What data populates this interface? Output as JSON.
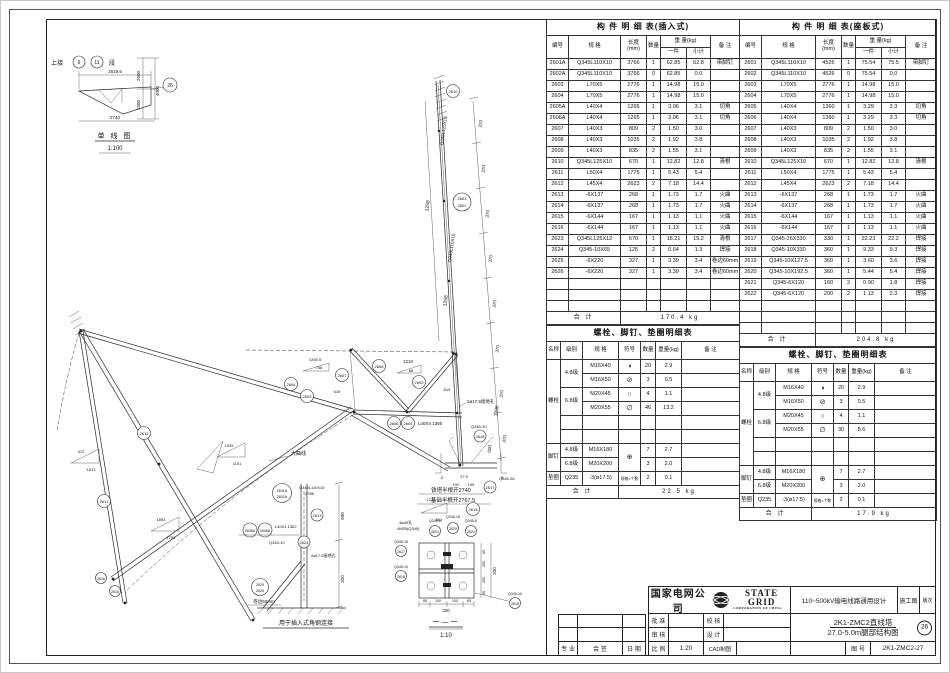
{
  "drawing": {
    "labels": {
      "shangjie": "上接",
      "c6": "6",
      "c11": "11",
      "duan": "段",
      "d2619": "2619.5",
      "d2500": "2500",
      "d4000": "4000",
      "d1500": "1500",
      "c26": "26",
      "d2740": "2740",
      "sl_title": "单 线 图",
      "sl_scale": "1:100",
      "p2610": "2610",
      "p2601": "2601",
      "p2602": "2602",
      "spec125": "Q345L125X10",
      "spec110": "Q345L110X10",
      "d1258": "1258",
      "d370": "370",
      "d1296": "1296",
      "d600": "600",
      "d320": "320",
      "p2603": "2603",
      "p2604": "2604",
      "p2611": "2611",
      "p2612": "2612",
      "p2607": "2607",
      "p2608": "2608",
      "p2609": "2609",
      "p2605": "2605",
      "p2606": "2606",
      "h2605": "L40X4 1360",
      "p2613": "2613",
      "p2614": "2614",
      "p2615": "2615",
      "p2616": "2616",
      "p2624": "2624",
      "q34510": "Q345-10",
      "p2625": "2625",
      "p2626": "2626",
      "juanbian": "卷边60mm",
      "p2601A": "2601A",
      "p2602A": "2602A",
      "len2766": "2766",
      "p2605A": "2605A",
      "p2606A": "2606A",
      "h2605A": "L40X4 1362",
      "jiedikong": "2ø17.5接地孔",
      "tower_half": "铁塔半根开2740",
      "found_half": "基础半根开2767.5",
      "p2617": "2617",
      "p2618": "2618",
      "p2619": "2619",
      "p2620": "2620",
      "p2621": "2621",
      "p2622": "2622",
      "q34526": "Q345-26",
      "q3456": "Q345-6",
      "q34516": "Q345-16",
      "holes": "4ø40孔",
      "boltsM": "4M30(Q345)",
      "sec_label": "一—一",
      "sec_scale": "1:10",
      "insert_note": "用于插入式角钢连接",
      "daquxian": "大曲线",
      "d372": "372",
      "d1813": "1813",
      "d1945": "1945",
      "d1151": "1151",
      "d1269": "1269.5",
      "d748": "748",
      "d1210": "1210",
      "d68": "68",
      "d615": "615",
      "d561": "561",
      "d1853": "1853",
      "d1751": "1751",
      "d330": "330",
      "d65": "65",
      "d100": "100",
      "d105": "105",
      "d27_5": "27.5",
      "sec_mark": "1"
    }
  },
  "tables": {
    "col": {
      "no": "编号",
      "spec": "规 格",
      "len": "长度 (mm)",
      "qty": "数量",
      "wt": "重 量(kg)",
      "one": "一件",
      "sub": "小计",
      "note": "备 注",
      "total_label": "合  计"
    },
    "insert": {
      "title": "构 件 明 细 表(插入式)",
      "rows": [
        [
          "2601A",
          "Q345L110X10",
          "3766",
          "1",
          "62.85",
          "62.8",
          "带脚钉"
        ],
        [
          "2602A",
          "Q345L110X10",
          "3766",
          "0",
          "62.85",
          "0.0",
          ""
        ],
        [
          "2603",
          "L70X5",
          "2776",
          "1",
          "14.98",
          "15.0",
          ""
        ],
        [
          "2604",
          "L70X5",
          "2776",
          "1",
          "14.98",
          "15.0",
          ""
        ],
        [
          "2605A",
          "L40X4",
          "1265",
          "1",
          "3.06",
          "3.1",
          "切角"
        ],
        [
          "2606A",
          "L40X4",
          "1265",
          "1",
          "3.06",
          "3.1",
          "切角"
        ],
        [
          "2607",
          "L40X3",
          "809",
          "2",
          "1.50",
          "3.0",
          ""
        ],
        [
          "2608",
          "L40X3",
          "1035",
          "2",
          "1.92",
          "3.8",
          ""
        ],
        [
          "2609",
          "L40X3",
          "835",
          "2",
          "1.55",
          "3.1",
          ""
        ],
        [
          "2610",
          "Q345L125X10",
          "670",
          "1",
          "12.82",
          "12.8",
          "清根"
        ],
        [
          "2611",
          "L50X4",
          "1775",
          "1",
          "5.43",
          "5.4",
          ""
        ],
        [
          "2612",
          "L45X4",
          "2623",
          "2",
          "7.18",
          "14.4",
          ""
        ],
        [
          "2613",
          "-6X137",
          "268",
          "1",
          "1.73",
          "1.7",
          "火曲"
        ],
        [
          "2614",
          "-6X137",
          "268",
          "1",
          "1.73",
          "1.7",
          "火曲"
        ],
        [
          "2615",
          "-6X144",
          "167",
          "1",
          "1.13",
          "1.1",
          "火曲"
        ],
        [
          "2616",
          "-6X144",
          "167",
          "1",
          "1.13",
          "1.1",
          "火曲"
        ],
        [
          "2623",
          "Q345L125X12",
          "670",
          "1",
          "15.21",
          "15.2",
          "清根"
        ],
        [
          "2624",
          "Q345-10X65",
          "125",
          "2",
          "0.64",
          "1.3",
          "焊接"
        ],
        [
          "2625",
          "-6X220",
          "327",
          "1",
          "3.39",
          "3.4",
          "卷边60mm"
        ],
        [
          "2626",
          "-6X220",
          "327",
          "1",
          "3.39",
          "3.4",
          "卷边60mm"
        ],
        [
          "",
          "",
          "",
          "",
          "",
          "",
          ""
        ],
        [
          "",
          "",
          "",
          "",
          "",
          "",
          ""
        ],
        [
          "",
          "",
          "",
          "",
          "",
          "",
          ""
        ]
      ],
      "total": "170.4 kg"
    },
    "seat": {
      "title": "构 件 明 细 表(座板式)",
      "rows": [
        [
          "2601",
          "Q345L110X10",
          "4526",
          "1",
          "75.54",
          "75.5",
          "带脚钉"
        ],
        [
          "2602",
          "Q345L110X10",
          "4526",
          "0",
          "75.54",
          "0.0",
          ""
        ],
        [
          "2603",
          "L70X5",
          "2776",
          "1",
          "14.98",
          "15.0",
          ""
        ],
        [
          "2604",
          "L70X5",
          "2776",
          "1",
          "14.98",
          "15.0",
          ""
        ],
        [
          "2605",
          "L40X4",
          "1360",
          "1",
          "3.29",
          "3.3",
          "切角"
        ],
        [
          "2606",
          "L40X4",
          "1360",
          "1",
          "3.29",
          "3.3",
          "切角"
        ],
        [
          "2607",
          "L40X3",
          "809",
          "2",
          "1.50",
          "3.0",
          ""
        ],
        [
          "2608",
          "L40X3",
          "1035",
          "2",
          "1.92",
          "3.8",
          ""
        ],
        [
          "2609",
          "L40X3",
          "835",
          "2",
          "1.55",
          "3.1",
          ""
        ],
        [
          "2610",
          "Q345L125X10",
          "670",
          "1",
          "12.82",
          "12.8",
          "清根"
        ],
        [
          "2611",
          "L50X4",
          "1775",
          "1",
          "5.43",
          "5.4",
          ""
        ],
        [
          "2612",
          "L45X4",
          "2623",
          "2",
          "7.18",
          "14.4",
          ""
        ],
        [
          "2613",
          "-6X137",
          "268",
          "1",
          "1.73",
          "1.7",
          "火曲"
        ],
        [
          "2614",
          "-6X137",
          "268",
          "1",
          "1.73",
          "1.7",
          "火曲"
        ],
        [
          "2615",
          "-6X144",
          "167",
          "1",
          "1.13",
          "1.1",
          "火曲"
        ],
        [
          "2616",
          "-6X144",
          "167",
          "1",
          "1.13",
          "1.1",
          "火曲"
        ],
        [
          "2617",
          "Q345-26X330",
          "330",
          "1",
          "22.23",
          "22.2",
          "焊接"
        ],
        [
          "2618",
          "Q345-10X330",
          "360",
          "1",
          "9.33",
          "9.3",
          "焊接"
        ],
        [
          "2619",
          "Q345-10X127.5",
          "360",
          "1",
          "3.60",
          "3.6",
          "焊接"
        ],
        [
          "2620",
          "Q345-10X192.5",
          "360",
          "1",
          "5.44",
          "5.4",
          "焊接"
        ],
        [
          "2621",
          "Q345-6X120",
          "160",
          "2",
          "0.90",
          "1.8",
          "焊接"
        ],
        [
          "2622",
          "Q345-6X120",
          "200",
          "2",
          "1.13",
          "2.3",
          "焊接"
        ],
        [
          "",
          "",
          "",
          "",
          "",
          "",
          ""
        ],
        [
          "",
          "",
          "",
          "",
          "",
          "",
          ""
        ],
        [
          "",
          "",
          "",
          "",
          "",
          "",
          ""
        ]
      ],
      "total": "204.8 kg"
    },
    "boltcol": {
      "name": "名称",
      "grade": "级别",
      "spec": "规 格",
      "sym": "符号",
      "qty": "数量",
      "wt": "重量(kg)",
      "note": "备 注",
      "total_label": "合  计"
    },
    "bolt_left": {
      "title": "螺栓、脚钉、垫圈明细表",
      "bolt": "螺栓",
      "foot": "脚钉",
      "washer": "垫圈",
      "rows": [
        {
          "grade": "4.8级",
          "spec": "M16X40",
          "sym": "◑",
          "qty": "20",
          "wt": "2.9"
        },
        {
          "spec": "M16X50",
          "sym": "⊘",
          "qty": "3",
          "wt": "0.5"
        },
        {
          "grade": "6.8级",
          "spec": "M20X45",
          "sym": "○",
          "qty": "4",
          "wt": "1.1"
        },
        {
          "spec": "M20X55",
          "sym": "∅",
          "qty": "46",
          "wt": "13.2"
        }
      ],
      "foot_rows": [
        {
          "grade": "4.8级",
          "spec": "M16X180",
          "qty": "7",
          "wt": "2.7"
        },
        {
          "grade": "6.8级",
          "spec": "M20X200",
          "qty": "3",
          "wt": "2.0"
        }
      ],
      "foot_sym": "⊕",
      "washer_row": {
        "grade": "Q235",
        "spec": "-3(ø17.5)",
        "sym": "规格×个数",
        "qty": "2",
        "wt": "0.1"
      },
      "total": "22.5 kg"
    },
    "bolt_right": {
      "title": "螺栓、脚钉、垫圈明细表",
      "bolt": "螺栓",
      "foot": "脚钉",
      "washer": "垫圈",
      "rows": [
        {
          "grade": "4.8级",
          "spec": "M16X40",
          "sym": "◑",
          "qty": "20",
          "wt": "2.9"
        },
        {
          "spec": "M16X50",
          "sym": "⊘",
          "qty": "3",
          "wt": "0.5"
        },
        {
          "grade": "6.8级",
          "spec": "M20X45",
          "sym": "○",
          "qty": "4",
          "wt": "1.1"
        },
        {
          "spec": "M20X55",
          "sym": "∅",
          "qty": "30",
          "wt": "8.6"
        }
      ],
      "foot_rows": [
        {
          "grade": "4.8级",
          "spec": "M16X180",
          "qty": "7",
          "wt": "2.7"
        },
        {
          "grade": "6.8级",
          "spec": "M20X200",
          "qty": "3",
          "wt": "2.0"
        }
      ],
      "foot_sym": "⊕",
      "washer_row": {
        "grade": "Q235",
        "spec": "-3(ø17.5)",
        "sym": "规格×个数",
        "qty": "2",
        "wt": "0.1"
      },
      "total": "17.9 kg"
    }
  },
  "titleblock": {
    "company": "国家电网公司",
    "brand": "STATE GRID",
    "brand_sub": "CORPORATION OF CHINA",
    "project": "110~500kV输电线路通用设计",
    "stage": "施工图",
    "rev": "版次",
    "approve": "批 准",
    "check": "校 核",
    "review": "审 核",
    "design": "设 计",
    "scale_label": "比 例",
    "scale": "1:20",
    "cad": "CAD制图",
    "title1": "2K1-ZMC2直线塔",
    "title2": "27.0-5.0m腿部结构图",
    "sheet_circle": "26",
    "dwg_label": "图 号",
    "dwg_no": "2K1-ZMC2-27",
    "col_major": "专 业",
    "col_sign": "会 签",
    "col_date": "日 期"
  }
}
